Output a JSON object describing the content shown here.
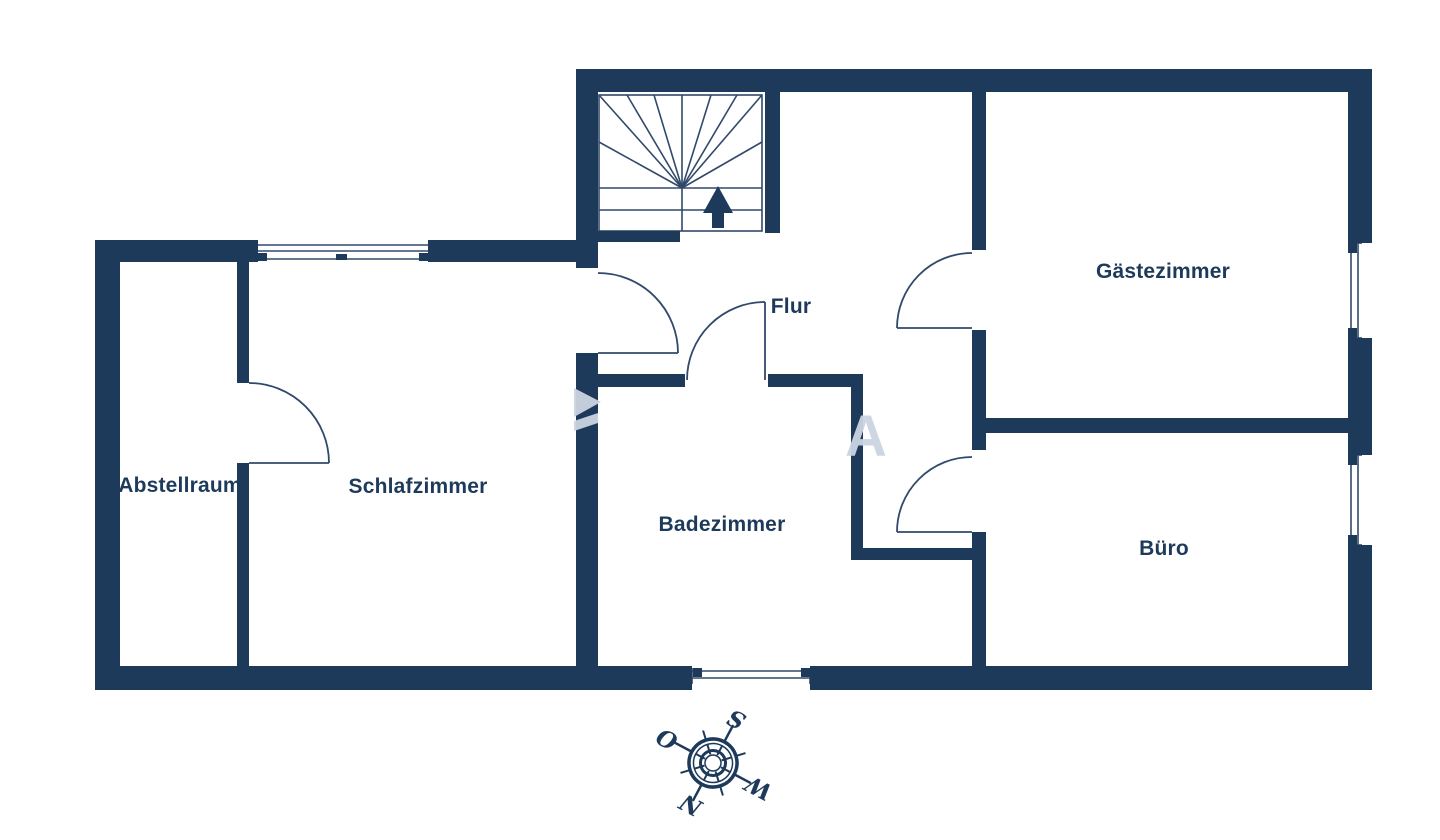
{
  "floorplan": {
    "rooms": [
      {
        "label": "Abstellraum"
      },
      {
        "label": "Schlafzimmer"
      },
      {
        "label": "Badezimmer"
      },
      {
        "label": "Flur"
      },
      {
        "label": "Gästezimmer"
      },
      {
        "label": "Büro"
      }
    ],
    "compass": {
      "north": "N",
      "east": "O",
      "south": "S",
      "west": "W"
    },
    "watermark_letter": "A",
    "colors": {
      "wall": "#1e3a5a",
      "thin_line": "#31496b",
      "watermark": "#ccd4e2",
      "background": "#ffffff"
    },
    "icons": {
      "compass": "compass-rose-icon",
      "stairs_direction": "up-arrow-icon"
    }
  }
}
